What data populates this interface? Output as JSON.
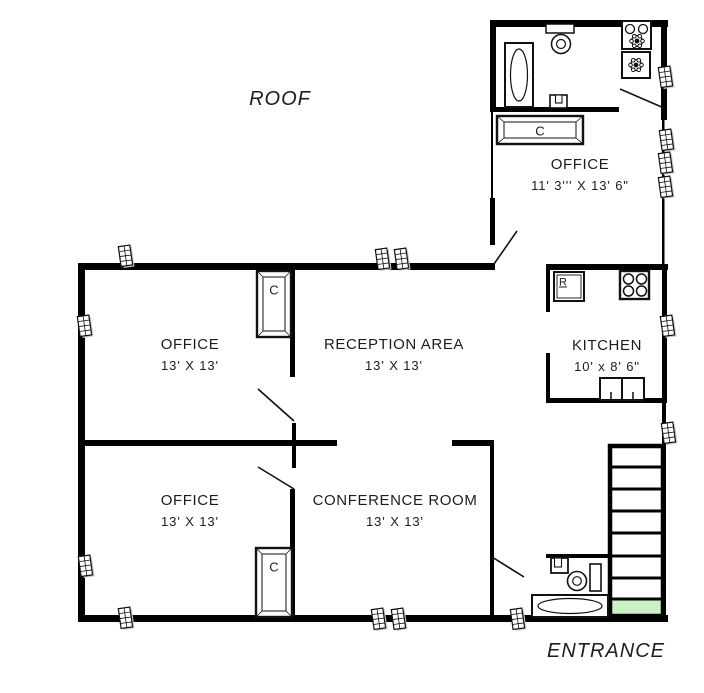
{
  "areas": {
    "roof": "ROOF",
    "entrance": "ENTRANCE"
  },
  "rooms": [
    {
      "name": "OFFICE",
      "dims": "11' 3''' X 13' 6\""
    },
    {
      "name": "OFFICE",
      "dims": "13' X 13'"
    },
    {
      "name": "RECEPTION AREA",
      "dims": "13' X 13'"
    },
    {
      "name": "KITCHEN",
      "dims": "10' x 8' 6\""
    },
    {
      "name": "OFFICE",
      "dims": "13' X 13'"
    },
    {
      "name": "CONFERENCE ROOM",
      "dims": "13' X 13'"
    }
  ],
  "labels": {
    "closet": "C",
    "refrigerator": "R"
  },
  "colors": {
    "wall": "#000000",
    "entrance_mat": "#cbf2c6",
    "window_shade": "#c9c9c9",
    "text": "#1d1d21"
  }
}
